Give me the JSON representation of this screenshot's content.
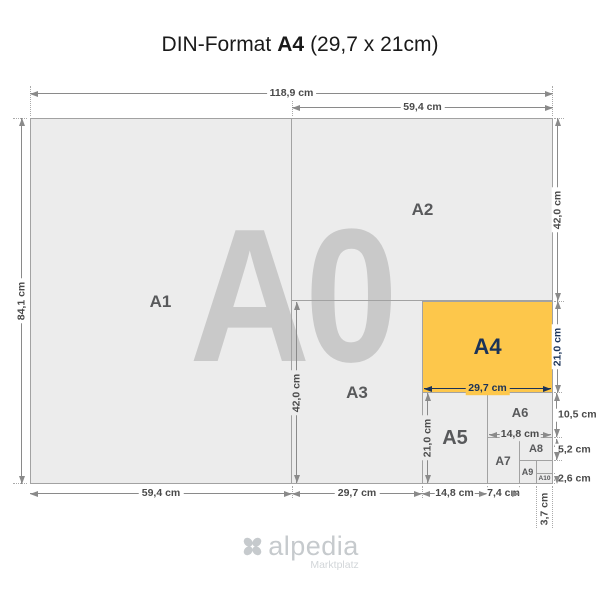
{
  "title": {
    "prefix": "DIN-Format",
    "emphasis": "A4",
    "suffix": "(29,7 x 21cm)"
  },
  "watermark": "A0",
  "sizes": {
    "a1": {
      "label": "A1"
    },
    "a2": {
      "label": "A2"
    },
    "a3": {
      "label": "A3"
    },
    "a4": {
      "label": "A4"
    },
    "a5": {
      "label": "A5"
    },
    "a6": {
      "label": "A6"
    },
    "a7": {
      "label": "A7"
    },
    "a8": {
      "label": "A8"
    },
    "a9": {
      "label": "A9"
    },
    "a10": {
      "label": "A10"
    }
  },
  "dims": {
    "total_width": "118,9 cm",
    "a2_width_top": "59,4 cm",
    "total_height": "84,1 cm",
    "a2_height_right": "42,0 cm",
    "a4_height_right": "21,0 cm",
    "a6_height_right": "10,5 cm",
    "a8_height_right": "5,2 cm",
    "a10_height_right": "2,6 cm",
    "a1_width_bottom": "59,4 cm",
    "a3_width_bottom": "29,7 cm",
    "a5_width_bottom": "14,8 cm",
    "a7_width_bottom": "7,4 cm",
    "a9_width_bottom": "3,7 cm",
    "a3_height_inner": "42,0 cm",
    "a5_height_inner": "21,0 cm",
    "a4_width_inner": "29,7 cm",
    "a6_width_inner": "14,8 cm"
  },
  "footer": {
    "brand": "alpedia",
    "tagline": "Marktplatz"
  },
  "colors": {
    "accent_orange": "#fdc74b",
    "navy": "#1b3358",
    "paper_fill": "#ececec",
    "watermark_gray": "#c9c9c9",
    "dimension_line_gray": "#8a8a8a",
    "label_gray": "#58595b",
    "logo_gray": "#c6cacd"
  }
}
